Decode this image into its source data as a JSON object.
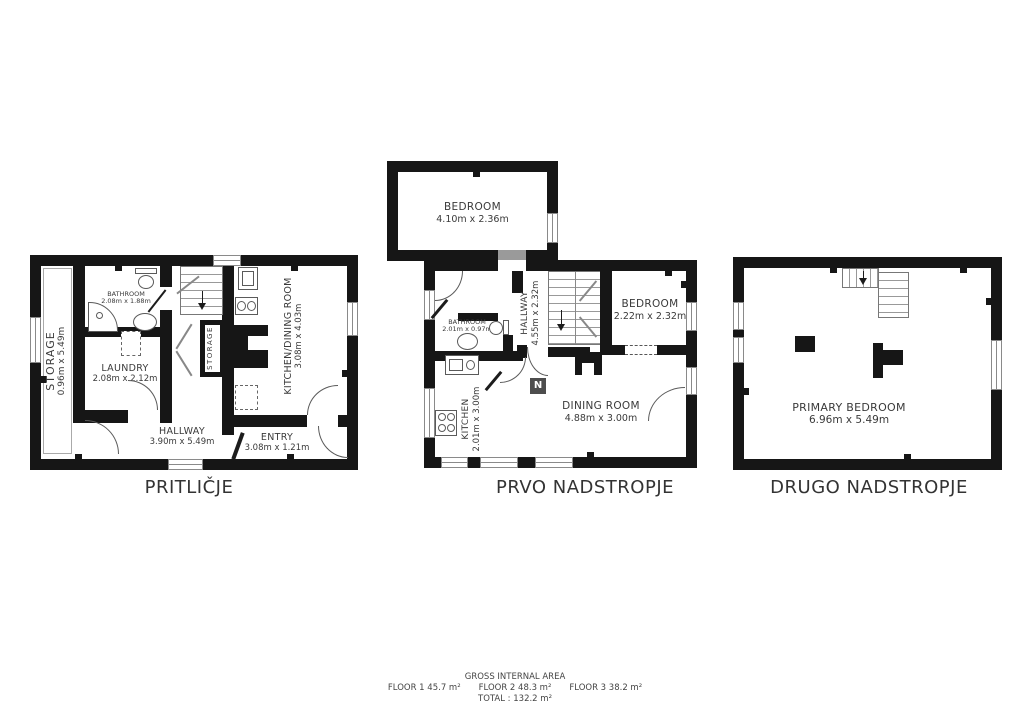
{
  "floorplan": {
    "plans": [
      {
        "title": "PRITLIČJE",
        "rooms": {
          "storage_side": {
            "name": "STORAGE",
            "dims": "0.96m x 5.49m"
          },
          "bathroom": {
            "name": "BATHROOM",
            "dims": "2.08m x 1.88m"
          },
          "laundry": {
            "name": "LAUNDRY",
            "dims": "2.08m x 2.12m"
          },
          "storage_closet": {
            "name": "STORAGE"
          },
          "kitchen_dining": {
            "name": "KITCHEN/DINING ROOM",
            "dims": "3.08m x 4.03m"
          },
          "hallway": {
            "name": "HALLWAY",
            "dims": "3.90m x 5.49m"
          },
          "entry": {
            "name": "ENTRY",
            "dims": "3.08m x 1.21m"
          }
        }
      },
      {
        "title": "PRVO NADSTROPJE",
        "rooms": {
          "bedroom_top": {
            "name": "BEDROOM",
            "dims": "4.10m x 2.36m"
          },
          "hallway": {
            "name": "HALLWAY",
            "dims": "4.55m x 2.32m"
          },
          "bathroom": {
            "name": "BATHROOM",
            "dims": "2.01m x 0.97m"
          },
          "bedroom_right": {
            "name": "BEDROOM",
            "dims": "2.22m x 2.32m"
          },
          "kitchen": {
            "name": "KITCHEN",
            "dims": "2.01m x 3.00m"
          },
          "dining": {
            "name": "DINING ROOM",
            "dims": "4.88m x 3.00m"
          }
        }
      },
      {
        "title": "DRUGO NADSTROPJE",
        "rooms": {
          "primary_bedroom": {
            "name": "PRIMARY BEDROOM",
            "dims": "6.96m x 5.49m"
          }
        }
      }
    ],
    "compass": {
      "label": "N"
    },
    "footer": {
      "heading": "GROSS INTERNAL AREA",
      "floors": [
        "FLOOR 1 45.7 m²",
        "FLOOR 2 48.3 m²",
        "FLOOR 3 38.2 m²"
      ],
      "total": "TOTAL :  132.2 m²"
    },
    "colors": {
      "wall": "#161616",
      "text": "#3a3a3a",
      "fixture_line": "#5a5a5a"
    }
  }
}
